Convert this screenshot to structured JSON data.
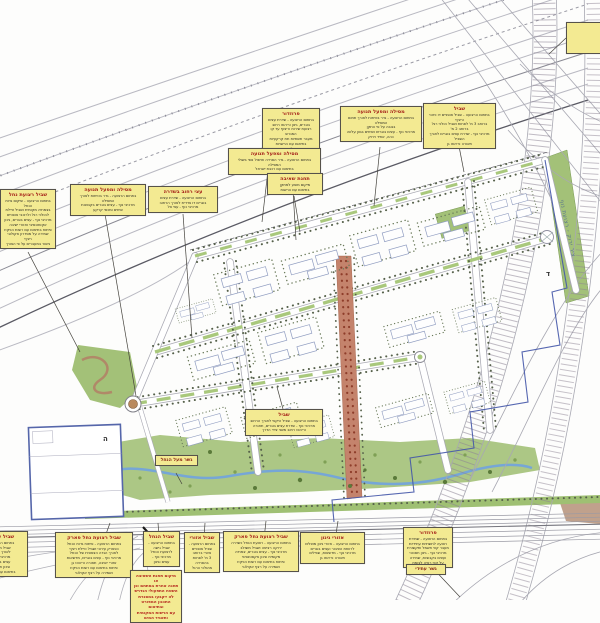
{
  "colors": {
    "label_bg": "#f3ea92",
    "label_border": "#56524a",
    "title_red": "#a6231a",
    "note_red": "#b5281e",
    "map_green": "#a3c178",
    "stream_blue": "#76a6d6",
    "boulevard_red": "#c4836c",
    "boundary_blue": "#4456a8"
  },
  "map_texts": {
    "green_axis_label": "ציר ירוק - רצועת נוף",
    "parcel_letters": [
      {
        "t": "ה",
        "x": 103,
        "y": 441
      },
      {
        "t": "ד",
        "x": 546,
        "y": 276
      }
    ]
  },
  "labels": [
    {
      "id": "landscape-corridor-line",
      "style": "plain",
      "x": 566,
      "y": 22,
      "w": 64,
      "h": 32,
      "title": "",
      "lines": [
        "קו מסדרון נוף"
      ],
      "leader": [
        566,
        38,
        549,
        54
      ]
    },
    {
      "id": "corridor-1",
      "style": "std",
      "x": 262,
      "y": 108,
      "w": 58,
      "title": "פרוזדור",
      "lines": [
        "בתחום הרצועה - שדרת עצים בוגרים, גינון וריהוט רחוב",
        "רצועת שירות וריצוף עד קו המגרש",
        "מעבר תשתיות תת קרקעיות בתיאום עם הרשויות",
        "שמירה על קווי ראיה"
      ],
      "leader": [
        290,
        141,
        296,
        240
      ]
    },
    {
      "id": "railway-traffic-1",
      "style": "std",
      "x": 340,
      "y": 106,
      "w": 82,
      "title": "מסילה ומפעל תנועה",
      "lines": [
        "בתחום הרצועה - גדר בטיחות לאורך תחום המסילה",
        "בגובה על פי התקן",
        "מרכיבי נוף - עצים בוגרים ושיחים בגוון עלווה",
        "כהה, אחיד וירוק"
      ],
      "leader": [
        380,
        147,
        374,
        206
      ]
    },
    {
      "id": "trail-1",
      "style": "std",
      "x": 423,
      "y": 103,
      "w": 73,
      "title": "שביל",
      "lines": [
        "בתחום הרצועה - שביל אופניים דו כיווני ורציף",
        "ברוחב 3 מ' לפחות ושביל הולכי רגל ברוחב 2 מ'",
        "מרכיבי נוף - שדרת עצים בוגרים לאורך השביל",
        "תאורה וריהוט גן"
      ],
      "leader": [
        458,
        141,
        464,
        172
      ]
    },
    {
      "id": "railway-traffic-2",
      "style": "std",
      "x": 228,
      "y": 148,
      "w": 93,
      "title": "מסילה ומפעל תנועה",
      "lines": [
        "בתחום הרצועה - גדר הפרדה וטיפול נופי בשולי המסילה",
        "בתיאום עם רכבת ישראל"
      ],
      "leader": [
        268,
        170,
        262,
        222
      ]
    },
    {
      "id": "pump-station",
      "style": "std",
      "x": 267,
      "y": 173,
      "w": 56,
      "title": "תחנת שאיבה",
      "lines": [
        "מיקום מוצע למתקן",
        "בתיאום עם הרשות"
      ],
      "leader": [
        294,
        196,
        300,
        232
      ]
    },
    {
      "id": "railway-traffic-3",
      "style": "std",
      "x": 70,
      "y": 184,
      "w": 76,
      "title": "מסילה ומפעל תנועה",
      "lines": [
        "בתחום הרצועה - גדר בטיחות לאורך המסילה",
        "מרכיבי נוף - עצים בוגרים בקבוצות",
        "שיחים ומכסי קרקע"
      ],
      "leader": [
        105,
        214,
        136,
        396
      ]
    },
    {
      "id": "street-trees",
      "style": "std",
      "x": 148,
      "y": 186,
      "w": 70,
      "title": "עצי רחוב בשדרה",
      "lines": [
        "בתחום הרצועה - שדרת עצים",
        "בוגרים דו צדדית לאורך הרחוב",
        "מרכיבי נוף - עצי צל"
      ],
      "leader": [
        183,
        214,
        192,
        338
      ]
    },
    {
      "id": "stream-trail-west",
      "style": "std",
      "x": 0,
      "y": 189,
      "w": 56,
      "title": "שביל רצועת נחל",
      "lines": [
        "בתחום הרצועה - שיקום גדות הנחל",
        "בצמחיה מקומית ושביל טיילת",
        "להולכי רגל ולרוכבי אופניים",
        "מרכיבי נוף - עצים בוגרים, גינון",
        "אקסטנסיבי ואזורי ישיבה",
        "פיתוח בתיאום עם רשות הניקוז",
        "שמירה על מסדרון אקולוגי רציף",
        "גישור במעברים על פי הצורך"
      ],
      "leader": [
        28,
        252,
        80,
        352
      ]
    },
    {
      "id": "trail-2",
      "style": "std",
      "x": 245,
      "y": 409,
      "w": 78,
      "title": "שביל",
      "lines": [
        "בתחום הרצועה - שביל היקפי לאורך הרחוב",
        "מרכיבי נוף - שדרת עצים בוגרים, תאורה",
        "וריהוט רחוב משני צידי הדרך"
      ],
      "leader": [
        283,
        409,
        277,
        387
      ]
    },
    {
      "id": "stream-bridge",
      "style": "plainred",
      "x": 155,
      "y": 455,
      "w": 43,
      "title": "",
      "lines": [
        "גשר מעל הנחל"
      ],
      "leader": [
        176,
        473,
        182,
        484
      ]
    },
    {
      "id": "urban-trail-west",
      "style": "std",
      "x": -26,
      "y": 531,
      "w": 54,
      "title": "שביל עירוני",
      "lines": [
        "בתחום הרצועה -",
        "שביל משולב",
        "לאורך הדרך",
        "מרכיבי נוף -",
        "עצים בוגרים",
        "וגינון חסכוני",
        "בתיאום עם הרשות"
      ]
    },
    {
      "id": "stream-park-trail-1",
      "style": "std",
      "x": 55,
      "y": 532,
      "w": 78,
      "title": "שביל רצועת נחל פארק",
      "lines": [
        "בתחום הרצועה - פיתוח גדות הנחל",
        "כפארק עירוני ושביל טיילת רציף",
        "לאורך הגדה הצפונית של הנחל",
        "מרכיבי נוף - עצים בוגרים, מדשאות",
        "אזורי ישיבה, תאורה וריהוט גן",
        "פיתוח בתיאום עם רשות הניקוז",
        "ושמירה על רצף אקולוגי"
      ],
      "leader": [
        94,
        567,
        110,
        523
      ]
    },
    {
      "id": "stream-access-trail",
      "style": "std",
      "x": 143,
      "y": 531,
      "w": 37,
      "title": "שביל הנחל",
      "lines": [
        "בתחום הרצועה -",
        "שביל גישה",
        "לרצועת הנחל",
        "מרכיבי נוף -",
        "עצים וגינון"
      ],
      "leader": [
        161,
        563,
        158,
        523
      ]
    },
    {
      "id": "regional-trail",
      "style": "std",
      "x": 184,
      "y": 532,
      "w": 36,
      "title": "שביל אזורי",
      "lines": [
        "בתחום הרצועה -",
        "שביל אופניים",
        "אזורי ברוחב",
        "3 מ' לפחות",
        "בהפרדה",
        "מהולכי הרגל"
      ],
      "leader": [
        202,
        570,
        205,
        523
      ]
    },
    {
      "id": "stream-park-trail-2",
      "style": "std",
      "x": 223,
      "y": 531,
      "w": 76,
      "title": "שביל רצועת נחל פארק",
      "lines": [
        "בתחום הרצועה - רצועת הנחל כשדרה",
        "ירוקה רציפה ושביל משולב",
        "מרכיבי נוף - עצים בוגרים, צמחיה",
        "מקומית וגינון אקסטנסיבי",
        "פיתוח בתיאום עם רשות הניקוז",
        "ושמירה על רצף אקולוגי"
      ],
      "leader": [
        261,
        566,
        266,
        521
      ]
    },
    {
      "id": "gardening-areas",
      "style": "std",
      "x": 300,
      "y": 532,
      "w": 65,
      "title": "אזורי גינון",
      "lines": [
        "בתחום הרצועה - אזורי גינון מוצלים",
        "לרווחת הציבור ועצים בוגרים",
        "מרכיבי נוף - מדשאות, שבילים",
        "תאורה וריהוט גן"
      ],
      "leader": [
        332,
        561,
        338,
        521
      ]
    },
    {
      "id": "corridor-2",
      "style": "std",
      "x": 403,
      "y": 527,
      "w": 50,
      "title": "פרוזדור",
      "lines": [
        "בתחום הרצועה - שמירת",
        "רצועה לתשתיות עתידיות",
        "מעבר קווי חשמל ותקשורת",
        "מרכיבי נוף - גינון חסכוני",
        "ועצים בקבוצות, שמירה",
        "על קווי ראיה לצומת"
      ],
      "leader": [
        428,
        563,
        460,
        597
      ]
    },
    {
      "id": "future-bridge",
      "style": "plainred",
      "x": 406,
      "y": 564,
      "w": 40,
      "title": "",
      "lines": [
        "גשר עתידי"
      ]
    },
    {
      "id": "pump-station-note",
      "style": "rednote",
      "x": 130,
      "y": 570,
      "w": 52,
      "title": "",
      "lines": [
        "מיקום תחנת השאיבה או",
        "תחנה אחרת במתחם וכן",
        "השטח התפעולי הנדרש",
        "לה ייקבעו במסגרת",
        "התכנון המפורט ובתיאום",
        "עם הרשות המקומית",
        "ותאגיד המים"
      ]
    }
  ]
}
